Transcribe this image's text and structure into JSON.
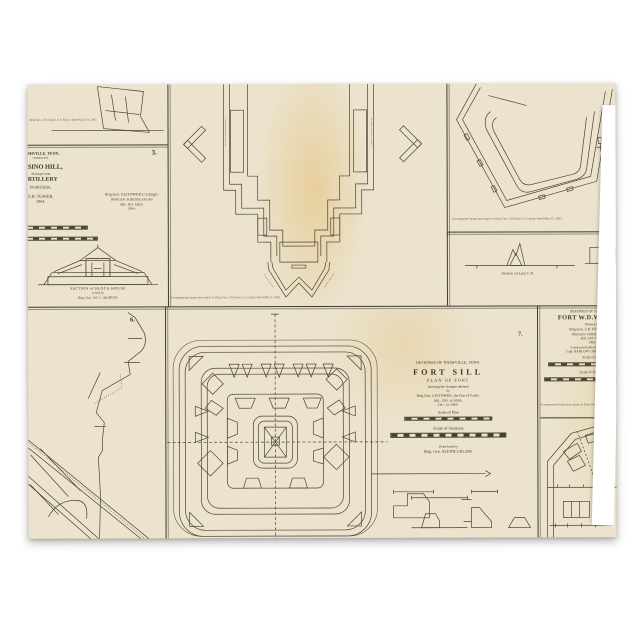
{
  "colors": {
    "page_bg": "#ffffff",
    "paper": "#ebe3cd",
    "ink": "#4c4334",
    "rule": "#413a2e",
    "hatch": "#3e372c",
    "aged_tint": "#e2b054"
  },
  "panel_top_fragment": {
    "caption": "Brig.Gen. Z.B.Tower U.S.Army, dated April 13, 1865."
  },
  "panel_casino_hill": {
    "number": "3.",
    "line1": "NASHVILLE, TENN.",
    "line2": "constructed.",
    "line3": "CASINO HILL,",
    "line4": "discharge from",
    "line5": "ARTILLERY",
    "line6": "POSITION.",
    "line7": "Z.B. TOWER,",
    "line8": "1864.",
    "credit1": "Brig.Gen. Z.B.TOWER U.S.Engrs.",
    "credit2": "INSP.GEN. FORTIFICATIONS",
    "credit3": "MIL. DIV. MISS.",
    "credit4": "1864.",
    "bh_cap1": "SECTION of BLOCK-HOUSE",
    "bh_cap2": "as built by",
    "bh_cap3": "Brig. Gen. JAS. C. MORTON."
  },
  "panel_large_fort": {
    "caption": "Accompanying Inspection report of Brig.Gen. Z.B.Tower U.S.Army, dated May 5, 1865."
  },
  "panel_pentagon_fort": {
    "caption": "Accompanied Inspection report of Brig.Gen. Z.B.Tower U.S.Army, dated May 15, 1865.",
    "section_label": "Section on Line C-D."
  },
  "panel_fort_whipple": {
    "region": "DEFENSES OF NASHVILLE",
    "title": "FORT W.D.WHIPPLE",
    "planned": "Planned by",
    "credit1": "Brig.Gen. Z.B.TOWER U.S.E.",
    "credit2": "INSP.GEN. FORTIFICATIONS",
    "credit3": "MIL. DIV. MISS.",
    "date": "1865.",
    "built1": "Constructed under the direction of",
    "built2": "Capt. BARLOW CORPS OF ENGRS.",
    "scale_plan": "Scale of Plan",
    "scale_sections": "Scale of Sections"
  },
  "panel_rifle_trench": {
    "number": "6."
  },
  "panel_fort_sill": {
    "number": "7.",
    "region": "DEFENSES OF NASHVILLE, TENN.",
    "title": "FORT SILL",
    "subtitle": "PLAN OF FORT",
    "note1": "showing the changes devised",
    "note2": "by",
    "note3": "Brig.Gen. Z.B.TOWER, Ins.Gen.of Fortfs.",
    "note4": "MIL. DIV. of MISS.",
    "date": "Dec. 1st 1864.",
    "scale_plan": "Scale of Plan",
    "scale_sections": "Scale of Sections",
    "built1": "Work built by",
    "built2": "Brig. Gen. ALEX'R GILLEM."
  },
  "panel_corner_fort": {
    "caption": "Accompanied Inspection report of Brig.Gen. Z.B.Tower U.S.Army."
  }
}
